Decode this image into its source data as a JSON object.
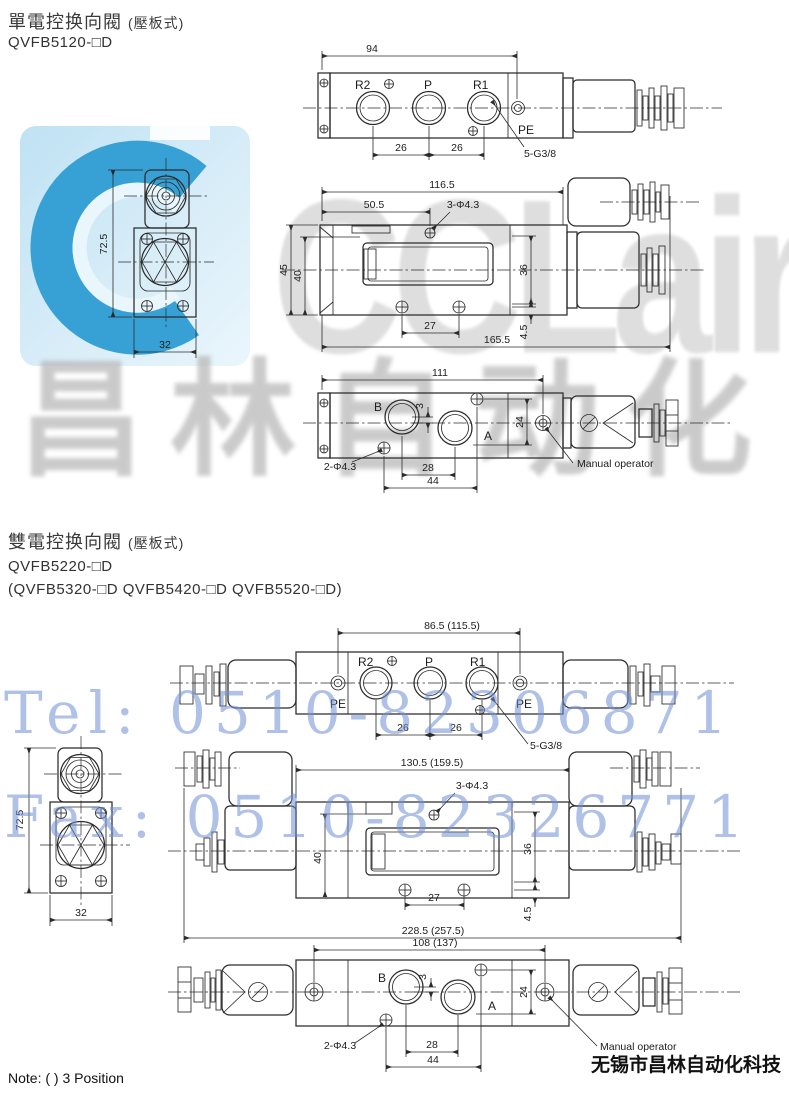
{
  "watermarks": {
    "logo_text": "CCLair",
    "cn": "昌林自动化",
    "tel": "Tel: 0510-82306871",
    "fax": "Fax: 0510-82326771"
  },
  "footer": {
    "note": "Note: ( ) 3 Position",
    "company": "无锡市昌林自动化科技"
  },
  "section1": {
    "title": "單電控换向閥",
    "subtitle": "(壓板式)",
    "model": "QVFB5120-□D"
  },
  "section2": {
    "title": "雙電控换向閥",
    "subtitle": "(壓板式)",
    "model": "QVFB5220-□D",
    "alt_models": "(QVFB5320-□D  QVFB5420-□D  QVFB5520-□D)"
  },
  "s_top": {
    "w": "94",
    "p1": "26",
    "p2": "26",
    "r2": "R2",
    "p": "P",
    "r1": "R1",
    "pe": "PE",
    "thread": "5-G3/8"
  },
  "s_end": {
    "h": "72.5",
    "w": "32"
  },
  "s_side": {
    "w": "116.5",
    "w2": "50.5",
    "holes": "3-Φ4.3",
    "h1": "45",
    "h2": "40",
    "h3": "36",
    "m": "27",
    "f": "4.5",
    "total": "165.5"
  },
  "s_bot": {
    "w": "111",
    "b": "B",
    "a": "A",
    "o": "3",
    "h": "24",
    "m": "28",
    "m2": "44",
    "holes": "2-Φ4.3",
    "manual": "Manual operator"
  },
  "d_top": {
    "w": "86.5 (115.5)",
    "p1": "26",
    "p2": "26",
    "r2": "R2",
    "p": "P",
    "r1": "R1",
    "pel": "PE",
    "per": "PE",
    "thread": "5-G3/8"
  },
  "d_end": {
    "h": "72.5",
    "w": "32"
  },
  "d_side": {
    "w": "130.5 (159.5)",
    "holes": "3-Φ4.3",
    "h2": "40",
    "h3": "36",
    "m": "27",
    "f": "4.5",
    "total": "228.5 (257.5)"
  },
  "d_bot": {
    "w": "108 (137)",
    "b": "B",
    "a": "A",
    "o": "3",
    "h": "24",
    "m": "28",
    "m2": "44",
    "holes": "2-Φ4.3",
    "manual": "Manual operator"
  }
}
